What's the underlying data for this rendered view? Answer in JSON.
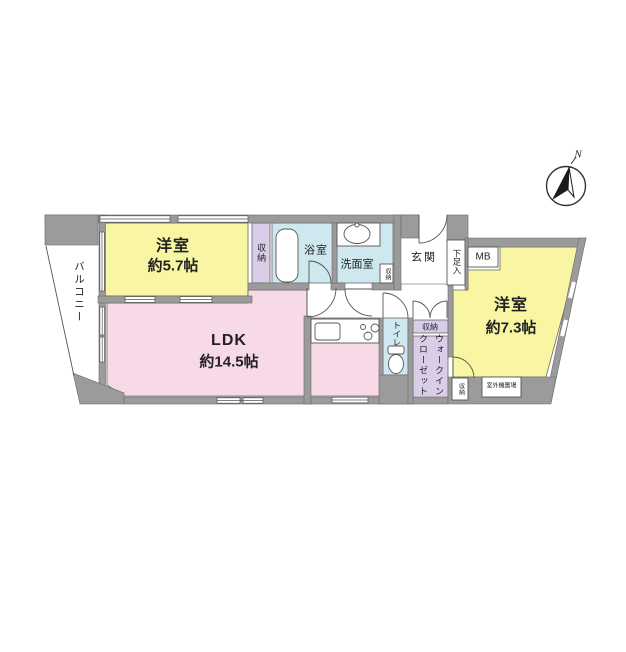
{
  "title": "マンション間取り図",
  "labels": {
    "balcony": "バルコニー",
    "bedroom1_name": "洋室",
    "bedroom1_size": "約5.7帖",
    "closet1": "収納",
    "bath": "浴室",
    "washroom": "洗面室",
    "washroom_storage": "収納",
    "entrance": "玄関",
    "shoe_cabinet": "下足入",
    "meter_box": "MB",
    "bedroom2_name": "洋室",
    "bedroom2_size": "約7.3帖",
    "ldk_name": "LDK",
    "ldk_size": "約14.5帖",
    "toilet": "トイレ",
    "hall_storage": "収納",
    "walk_in_closet": "ウォークインクローゼット",
    "small_storage": "収納",
    "outdoor_unit": "室外機置場",
    "north": "N"
  },
  "colors": {
    "room_yellow": "#f8f6a2",
    "room_pink": "#f8d9e7",
    "room_purple": "#d9cde8",
    "room_blue": "#cfe8f0",
    "wall_gray": "#9b9b9b",
    "line": "#555555",
    "background": "#ffffff"
  }
}
